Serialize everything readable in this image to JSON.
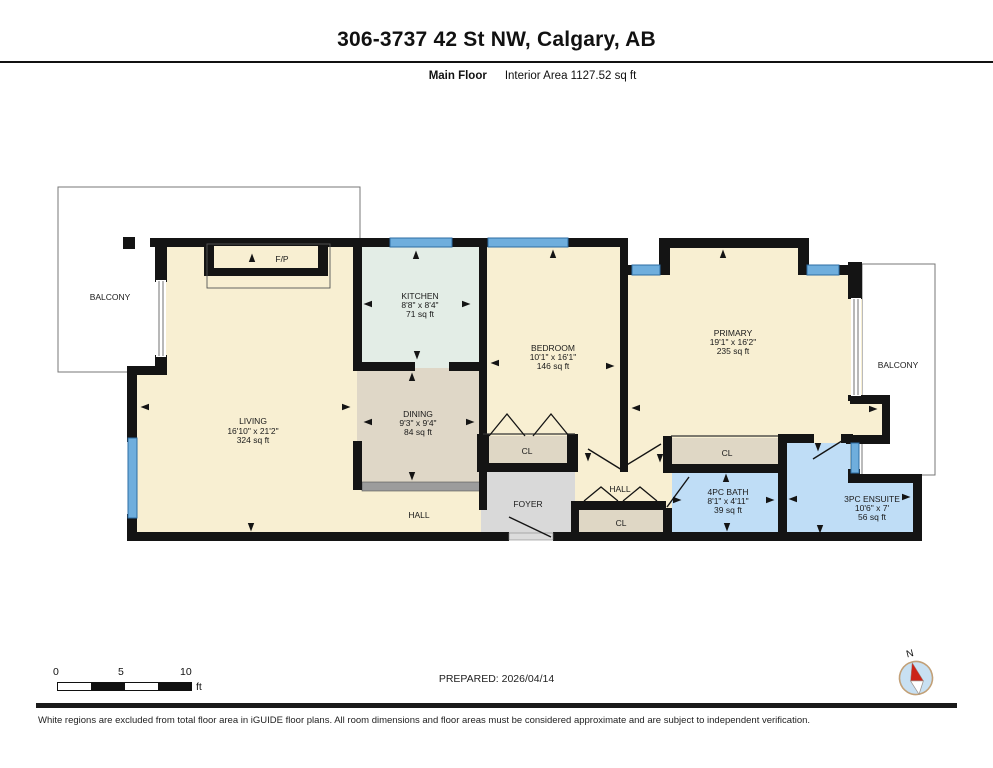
{
  "header": {
    "title": "306-3737 42 St NW, Calgary, AB",
    "floor_label": "Main Floor",
    "area_label": "Interior Area 1127.52 sq ft"
  },
  "rooms": {
    "living": {
      "name": "LIVING",
      "dims": "16'10\" x 21'2\"",
      "area": "324 sq ft"
    },
    "kitchen": {
      "name": "KITCHEN",
      "dims": "8'8\" x 8'4\"",
      "area": "71 sq ft"
    },
    "dining": {
      "name": "DINING",
      "dims": "9'3\" x 9'4\"",
      "area": "84 sq ft"
    },
    "bedroom": {
      "name": "BEDROOM",
      "dims": "10'1\" x 16'1\"",
      "area": "146 sq ft"
    },
    "primary": {
      "name": "PRIMARY",
      "dims": "19'1\" x 16'2\"",
      "area": "235 sq ft"
    },
    "bath": {
      "name": "4PC BATH",
      "dims": "8'1\" x 4'11\"",
      "area": "39 sq ft"
    },
    "ensuite": {
      "name": "3PC ENSUITE",
      "dims": "10'6\" x 7'",
      "area": "56 sq ft"
    }
  },
  "labels": {
    "balcony_left": "BALCONY",
    "balcony_right": "BALCONY",
    "hall_main": "HALL",
    "hall_right": "HALL",
    "foyer": "FOYER",
    "closet_bedroom": "CL",
    "closet_hall": "CL",
    "closet_primary": "CL",
    "fireplace": "F/P",
    "north": "N"
  },
  "scale_bar": {
    "ticks": [
      "0",
      "5",
      "10"
    ],
    "unit": "ft"
  },
  "footer": {
    "prepared": "PREPARED: 2026/04/14",
    "disclaimer": "White regions are excluded from total floor area in iGUIDE floor plans. All room dimensions and floor areas must be considered approximate and are subject to independent verification."
  },
  "colors": {
    "wall": "#141414",
    "cream": "#F8EFD2",
    "kitchen": "#E3EDE6",
    "dining": "#DFD7C7",
    "closet": "#DFD7C5",
    "bath": "#BFDDF6",
    "foyer": "#D9D9D9",
    "window": "#6FAEDD",
    "railing": "#9C9C9C",
    "compass_fill": "#C8E0F2",
    "compass_ring": "#C2A077",
    "compass_red": "#CC2418"
  }
}
